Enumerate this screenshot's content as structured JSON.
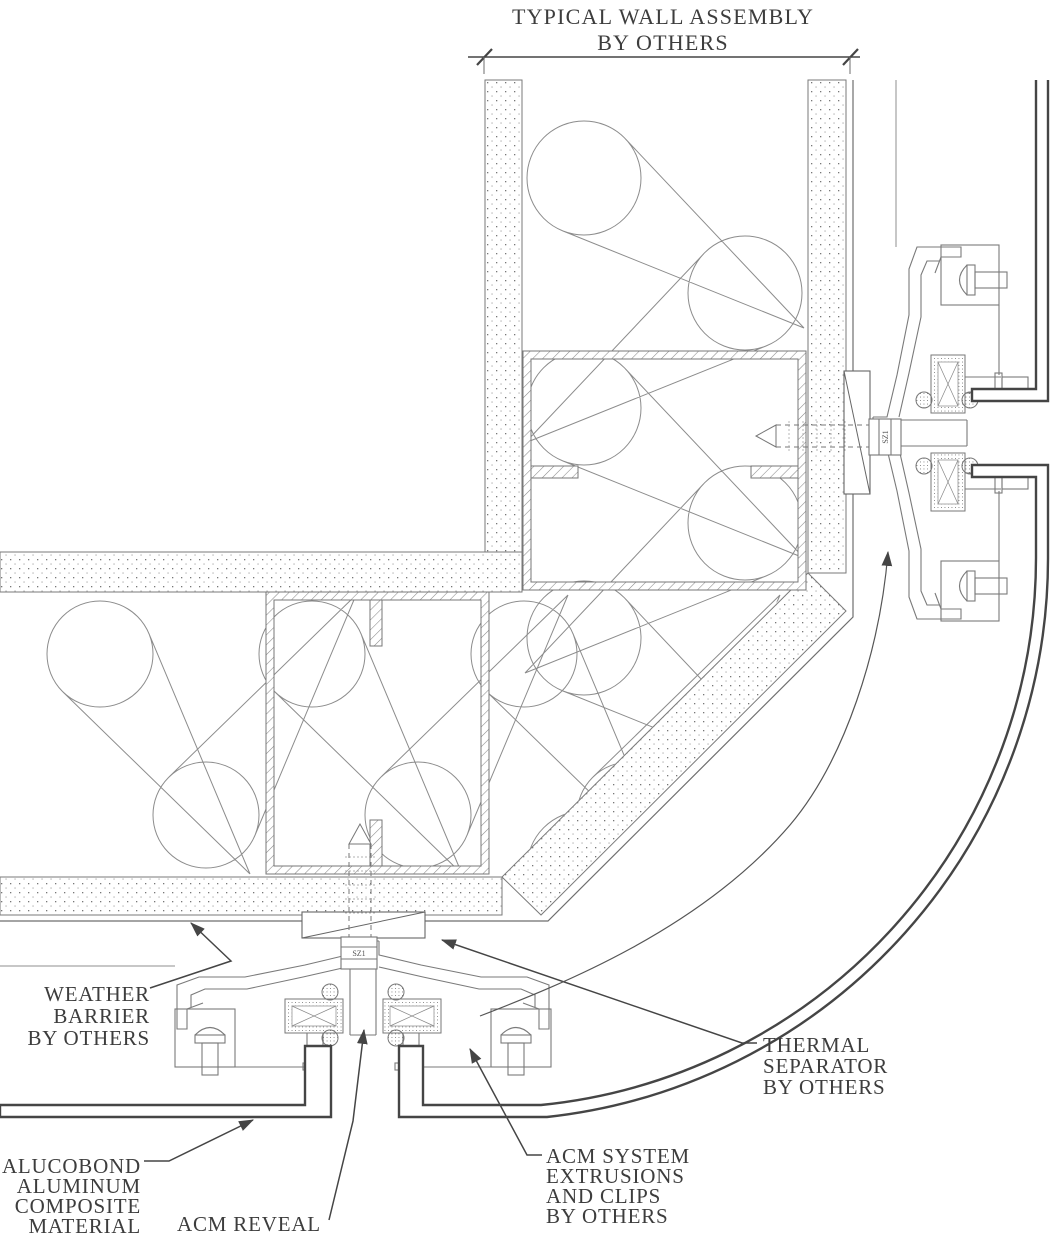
{
  "drawing": {
    "title_dimension": {
      "label_lines": [
        "TYPICAL WALL ASSEMBLY",
        "BY OTHERS"
      ]
    },
    "callouts": {
      "weather_barrier": {
        "lines": [
          "WEATHER",
          "BARRIER",
          "BY OTHERS"
        ]
      },
      "thermal_separator": {
        "lines": [
          "THERMAL",
          "SEPARATOR",
          "BY OTHERS"
        ]
      },
      "acm_system": {
        "lines": [
          "ACM SYSTEM",
          "EXTRUSIONS",
          "AND CLIPS",
          "BY OTHERS"
        ]
      },
      "alucobond": {
        "lines": [
          "ALUCOBOND",
          "ALUMINUM",
          "COMPOSITE",
          "MATERIAL"
        ]
      },
      "acm_reveal": {
        "lines": [
          "ACM REVEAL"
        ]
      }
    },
    "fastener_mark": "SZ1",
    "colors": {
      "line_light": "#8c8c8c",
      "line_medium": "#6e6e6e",
      "line_dark": "#454545",
      "text": "#3d3d3d",
      "background": "#ffffff"
    }
  }
}
